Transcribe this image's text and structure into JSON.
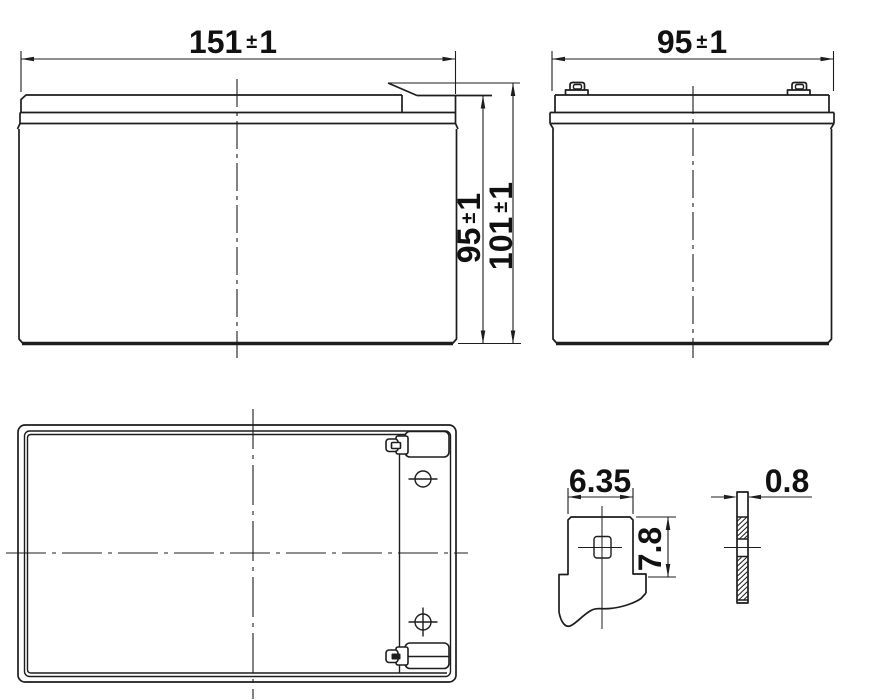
{
  "drawing": {
    "ink_color": "#1d1d1d",
    "background_color": "#ffffff",
    "dimensions": {
      "front_width": {
        "value": "151",
        "pm": "±",
        "tol": "1"
      },
      "side_width": {
        "value": "95",
        "pm": "±",
        "tol": "1"
      },
      "case_height": {
        "value": "95",
        "pm": "±",
        "tol": "1"
      },
      "overall_height": {
        "value": "101",
        "pm": "±",
        "tol": "1"
      },
      "terminal_width": {
        "value": "6.35"
      },
      "terminal_tab_height": {
        "value": "7.8"
      },
      "terminal_thickness": {
        "value": "0.8"
      }
    }
  }
}
